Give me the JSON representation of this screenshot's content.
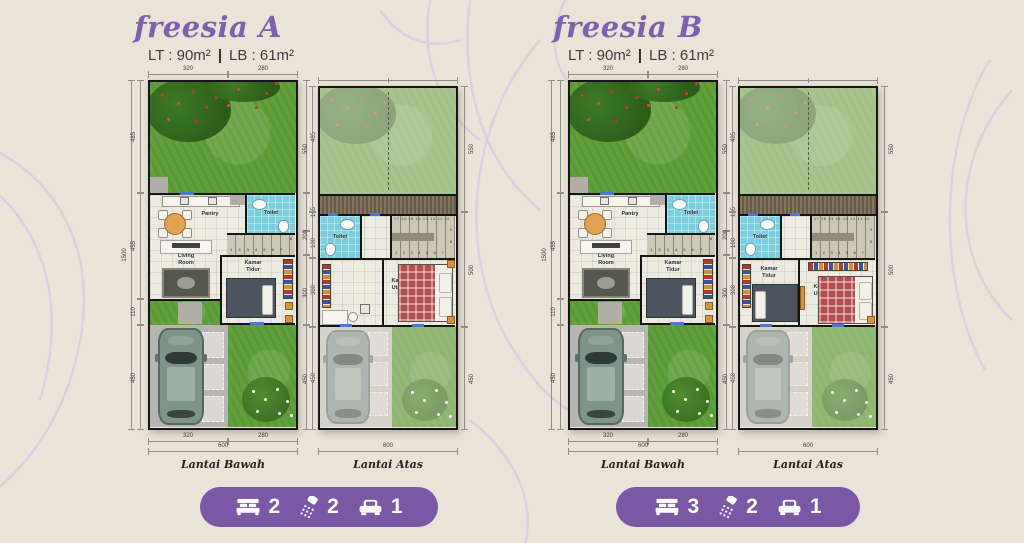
{
  "page": {
    "background_color": "#eae3d8",
    "pattern_color": "#d5c9e2",
    "accent_color": "#7a58a6",
    "title_color": "#7d61ad"
  },
  "labels": {
    "lantai_bawah": "Lantai Bawah",
    "lantai_atas": "Lantai Atas",
    "pantry": "Pantry",
    "toilet": "Toilet",
    "living_room": "Living Room",
    "kamar_tidur": "Kamar Tidur",
    "kamar_utama": "Kamar Utama",
    "stairs_lower": "1 2 3 4 5 6 7",
    "stairs_upper": "17 16 15 14 13 12 11 10",
    "stair_9": "9",
    "stair_8": "8"
  },
  "dims": {
    "bawah": {
      "top": [
        "320",
        "280"
      ],
      "left_total": "1500",
      "left": [
        "485",
        "455",
        "110",
        "450"
      ],
      "right": [
        "485",
        "165",
        "100",
        "300",
        "450"
      ],
      "bottom": [
        "320",
        "280"
      ],
      "bottom_total": "600"
    },
    "atas": {
      "left": [
        "550",
        "200",
        "300",
        "450"
      ],
      "right": [
        "550",
        "500",
        "450"
      ],
      "bottom_total": "600"
    }
  },
  "units": [
    {
      "name": "freesia A",
      "spec_lt": "LT : 90m²",
      "spec_divider": "|",
      "spec_lb": "61m²",
      "spec_lb_full": "LB : 61m²",
      "badge": [
        {
          "icon": "bed",
          "value": "2"
        },
        {
          "icon": "shower",
          "value": "2"
        },
        {
          "icon": "car",
          "value": "1"
        }
      ]
    },
    {
      "name": "freesia B",
      "spec_lt": "LT : 90m²",
      "spec_divider": "|",
      "spec_lb": "61m²",
      "spec_lb_full": "LB : 61m²",
      "badge": [
        {
          "icon": "bed",
          "value": "3"
        },
        {
          "icon": "shower",
          "value": "2"
        },
        {
          "icon": "car",
          "value": "1"
        }
      ]
    }
  ]
}
